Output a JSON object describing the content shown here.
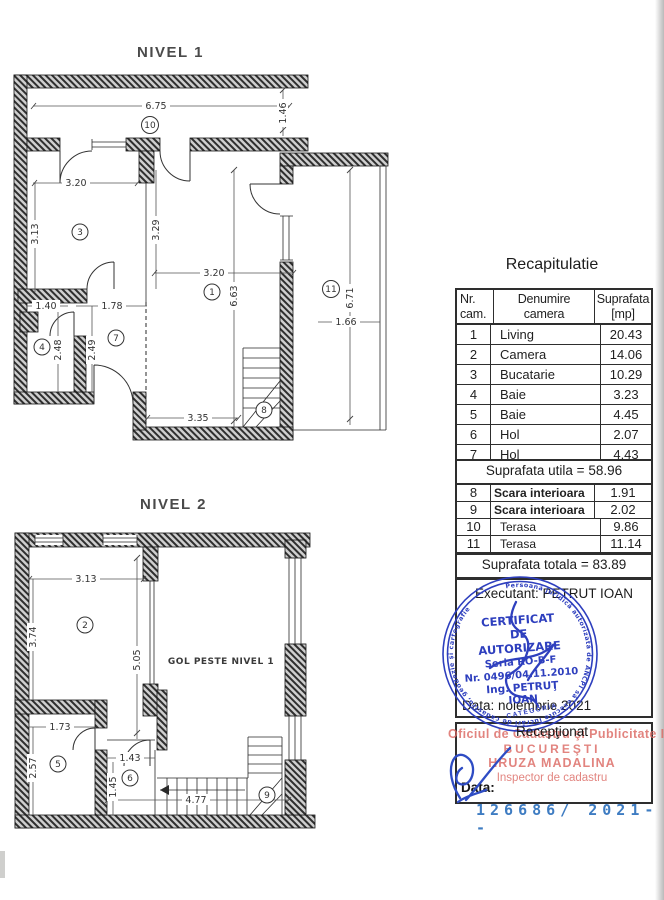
{
  "document": {
    "serial": "126686/ 2021--",
    "serial_color": "#3e7cc2"
  },
  "nivel1": {
    "title": "NIVEL 1",
    "rooms": {
      "living": "1",
      "bucatarie": "3",
      "baie": "4",
      "hol": "7",
      "scara": "8",
      "terasa_top": "10",
      "terasa_right": "11"
    },
    "dims": {
      "terasa_w": "6.75",
      "terasa_h": "1.46",
      "cam3_w": "3.20",
      "cam3_h": "3.13",
      "cam3_h2": "3.29",
      "living_w": "3.20",
      "living_h": "6.63",
      "living_bw": "3.35",
      "terasa11_h": "6.71",
      "terasa11_w": "1.66",
      "baie_w": "1.40",
      "baie_h": "2.48",
      "hol_w": "1.78",
      "hol_h": "2.49"
    }
  },
  "nivel2": {
    "title": "NIVEL 2",
    "gol_label": "GOL PESTE NIVEL 1",
    "rooms": {
      "camera": "2",
      "baie": "5",
      "hol": "6",
      "scara": "9"
    },
    "dims": {
      "cam2_w": "3.13",
      "cam2_h": "3.74",
      "cam2_h2": "5.05",
      "baie_w": "1.73",
      "baie_h": "2.57",
      "hol_w": "1.43",
      "hol_h": "1.45",
      "scara_w": "4.77"
    }
  },
  "recap": {
    "title": "Recapitulatie",
    "header": {
      "nr1": "Nr.",
      "nr2": "cam.",
      "den1": "Denumire",
      "den2": "camera",
      "sup1": "Suprafata",
      "sup2": "[mp]"
    },
    "rows1": [
      {
        "nr": "1",
        "name": "Living",
        "area": "20.43"
      },
      {
        "nr": "2",
        "name": "Camera",
        "area": "14.06"
      },
      {
        "nr": "3",
        "name": "Bucatarie",
        "area": "10.29"
      },
      {
        "nr": "4",
        "name": "Baie",
        "area": "3.23"
      },
      {
        "nr": "5",
        "name": "Baie",
        "area": "4.45"
      },
      {
        "nr": "6",
        "name": "Hol",
        "area": "2.07"
      },
      {
        "nr": "7",
        "name": "Hol",
        "area": "4.43"
      }
    ],
    "utila": "Suprafata utila = 58.96",
    "rows2": [
      {
        "nr": "8",
        "name": "Scara interioara",
        "area": "1.91"
      },
      {
        "nr": "9",
        "name": "Scara interioara",
        "area": "2.02"
      },
      {
        "nr": "10",
        "name": "Terasa",
        "area": "9.86"
      },
      {
        "nr": "11",
        "name": "Terasa",
        "area": "11.14"
      }
    ],
    "totala": "Suprafata totala = 83.89"
  },
  "executant": {
    "line": "Executant: PETRUT IOAN",
    "date_line": "Data: noiembrie 2021"
  },
  "stamp": {
    "ring_text": "Persoană juridică autorizată de ANCPI să execute lucrări de cadastru, geodezie şi cartografie",
    "category": "CATEGORIA",
    "lines": [
      "CERTIFICAT",
      "DE",
      "AUTORIZARE",
      "Seria RO-B-F",
      "Nr. 0496/04.11.2010",
      "Ing. PETRUŢ",
      "IOAN"
    ],
    "color": "#2e3fbe"
  },
  "receptionat": {
    "title": "Recepţionat",
    "date_label": "Data:",
    "red_stamp": {
      "line1": "Oficiul de Cadastru şi Publicitate Imobiliară",
      "line2": "BUCUREŞTI",
      "line3": "HRUZA MADALINA",
      "line4": "Inspector de cadastru",
      "color": "#dc6a64"
    }
  }
}
